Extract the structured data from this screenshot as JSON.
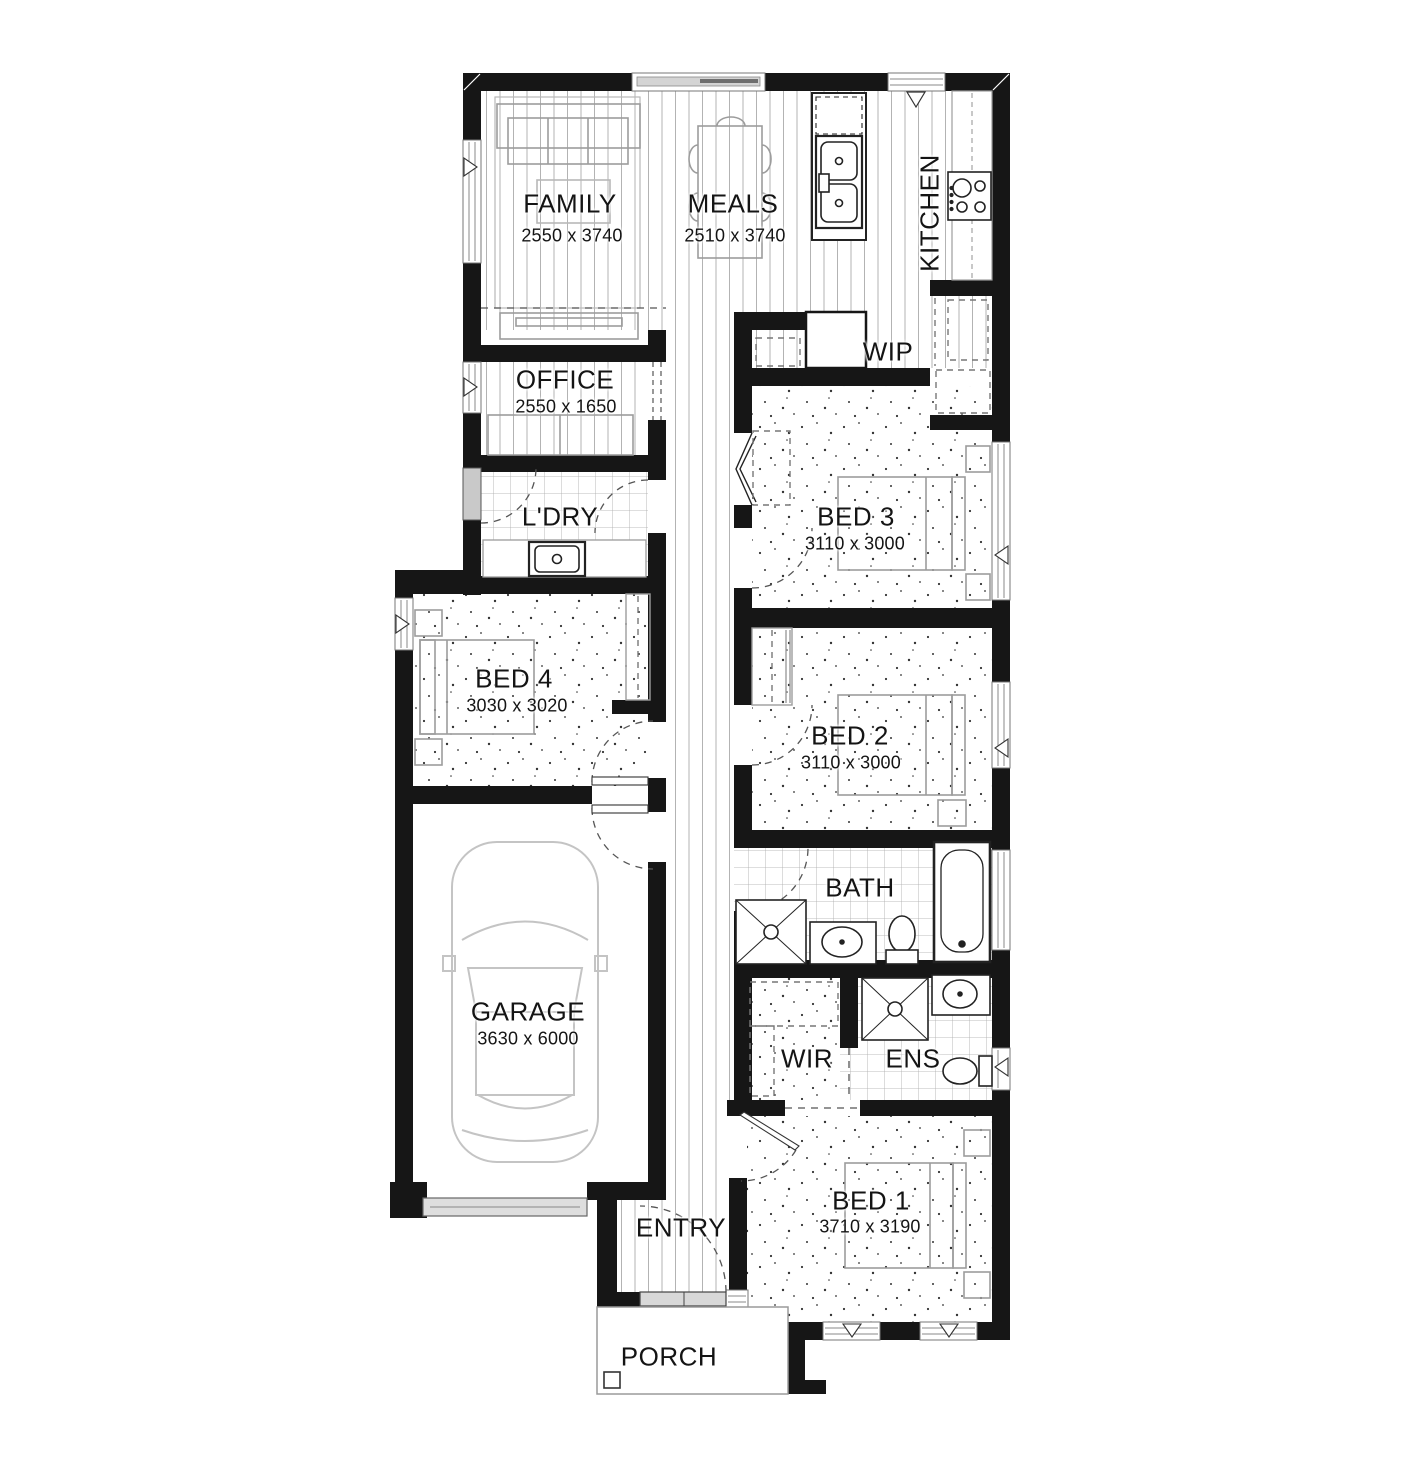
{
  "plan": {
    "title": "Single storey house floor plan",
    "rooms": {
      "family": {
        "name": "FAMILY",
        "size": "2550 x 3740"
      },
      "meals": {
        "name": "MEALS",
        "size": "2510 x 3740"
      },
      "kitchen": {
        "name": "KITCHEN"
      },
      "wip": {
        "name": "WIP"
      },
      "office": {
        "name": "OFFICE",
        "size": "2550 x 1650"
      },
      "laundry": {
        "name": "L'DRY"
      },
      "bed3": {
        "name": "BED 3",
        "size": "3110 x 3000"
      },
      "bed4": {
        "name": "BED 4",
        "size": "3030 x 3020"
      },
      "bed2": {
        "name": "BED 2",
        "size": "3110 x 3000"
      },
      "bath": {
        "name": "BATH"
      },
      "garage": {
        "name": "GARAGE",
        "size": "3630 x 6000"
      },
      "wir": {
        "name": "WIR"
      },
      "ens": {
        "name": "ENS"
      },
      "bed1": {
        "name": "BED 1",
        "size": "3710 x 3190"
      },
      "entry": {
        "name": "ENTRY"
      },
      "porch": {
        "name": "PORCH"
      }
    },
    "colors": {
      "wall": "#161616",
      "fixture": "#222222",
      "furniture": "#9c9c9c",
      "floor_line": "#b3b3b3"
    }
  }
}
